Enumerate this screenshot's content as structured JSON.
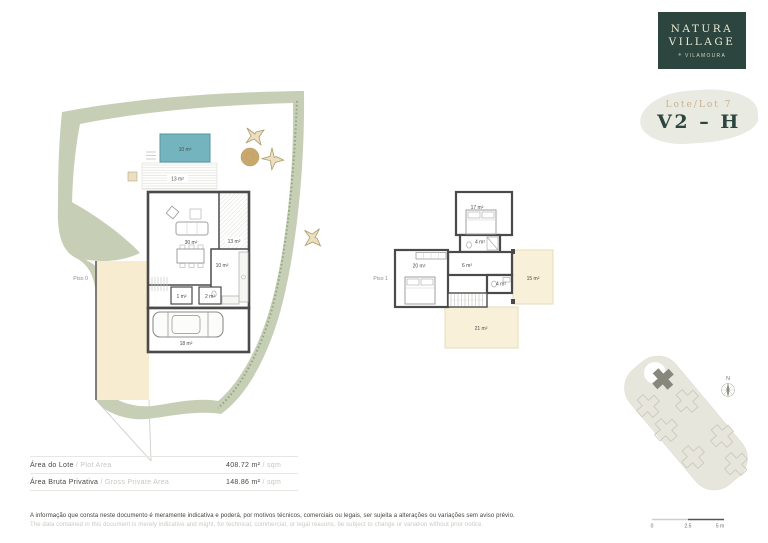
{
  "brand": {
    "name_line1": "NATURA",
    "name_line2": "VILLAGE",
    "location": "VILAMOURA",
    "mark": "✳"
  },
  "badge": {
    "lot": "Lote/Lot 7",
    "unit": "V2 – H"
  },
  "plans": {
    "piso0": {
      "label": "Piso 0",
      "pool": "10 m²",
      "deck": "13 m²",
      "living": "30 m²",
      "terrace": "13 m²",
      "kitchen": "10 m²",
      "closet": "1 m²",
      "wc": "2 m²",
      "garage": "18 m²"
    },
    "piso1": {
      "label": "Piso 1",
      "bedroom_a": "17 m²",
      "bath_a": "4 m²",
      "hall": "6 m²",
      "bedroom_b": "20 m²",
      "bath_b": "4 m²",
      "terrace_side": "15 m²",
      "terrace_rear": "21 m²"
    }
  },
  "areas": {
    "rows": [
      {
        "label_pt": "Área do Lote",
        "label_en": " / Plot Area",
        "value": "408.72 m²",
        "unit": " / sqm"
      },
      {
        "label_pt": "Área Bruta Privativa",
        "label_en": " / Gross Private Area",
        "value": "148.86 m²",
        "unit": " / sqm"
      }
    ]
  },
  "disclaimer": {
    "pt": "A informação que consta neste documento é meramente indicativa e poderá, por motivos técnicos, comerciais ou legais, ser sujeita a alterações ou variações sem aviso prévio.",
    "en": "The data contained in this document is merely indicative and might, for technical, commercial, or legal reasons, be subject to change or variation without prior notice."
  },
  "scale_bar": {
    "zero": "0",
    "mid": "2.5",
    "max": "5 m"
  },
  "compass": {
    "north": "N"
  },
  "colors": {
    "brand_green": "#2c463f",
    "pool": "#74b4be",
    "garden": "#c6cfb6",
    "sand": "#f7eccf",
    "tan": "#c9b28a"
  }
}
